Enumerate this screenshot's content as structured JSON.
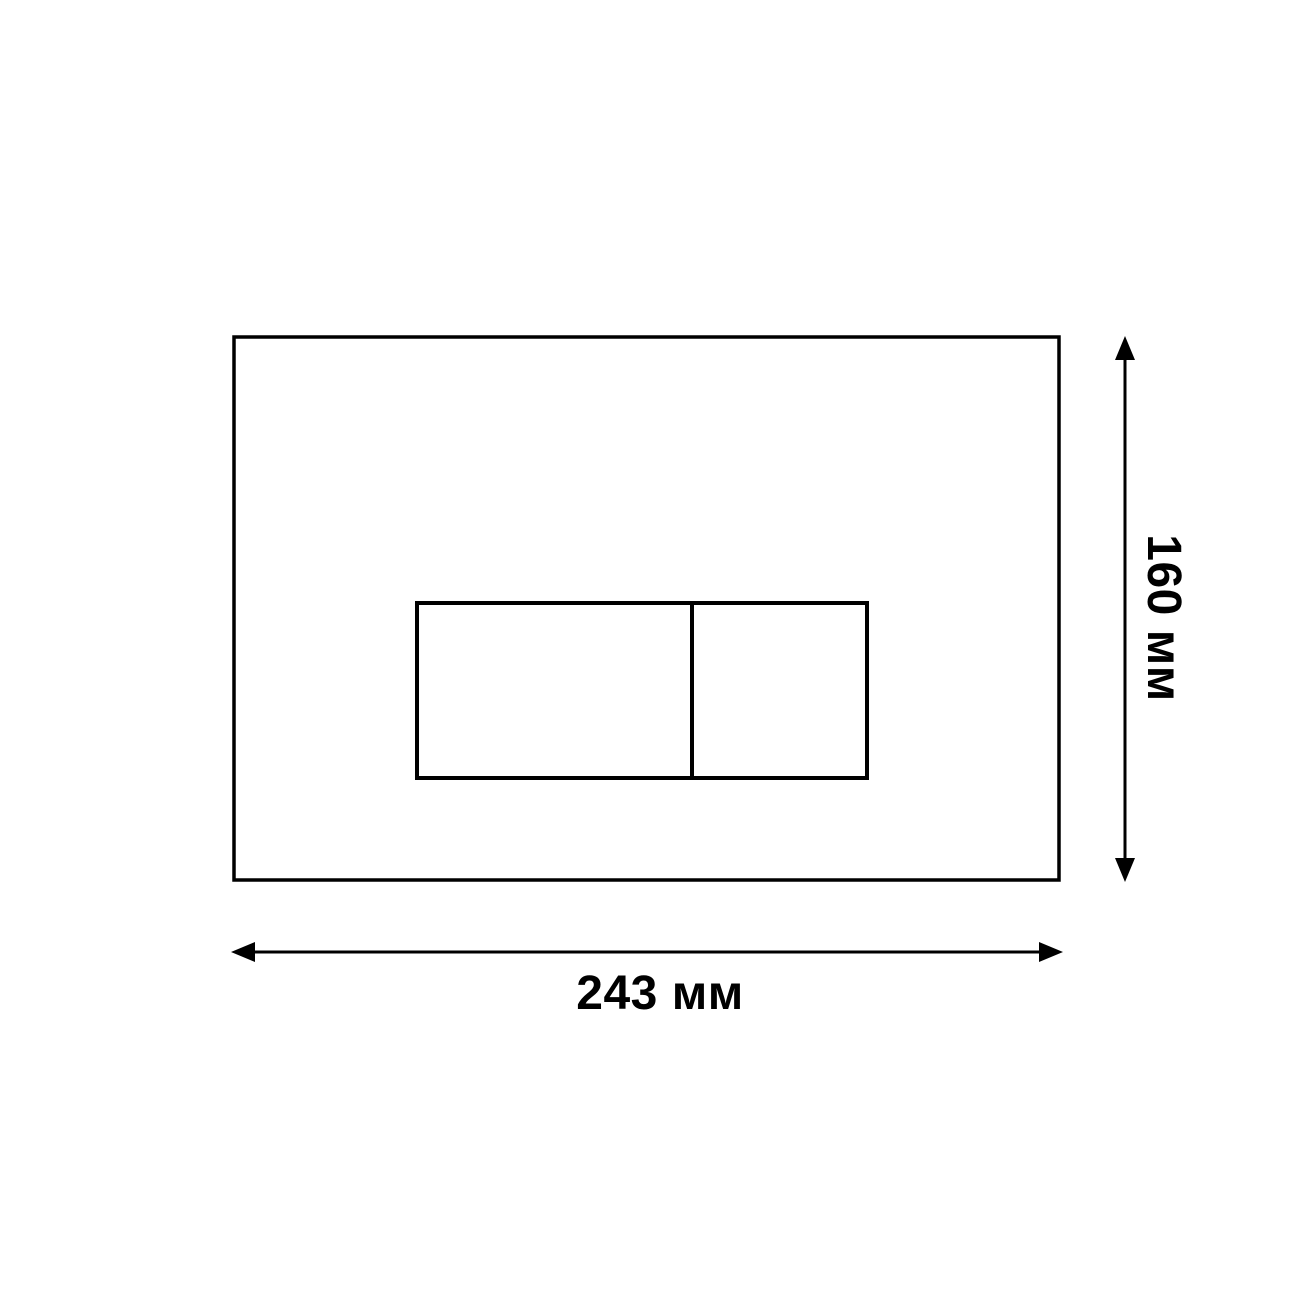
{
  "diagram": {
    "type": "technical-dimension-drawing",
    "description_visible_elements": "outer rectangular plate with inner two-button rectangle, width and height dimension arrows"
  },
  "labels": {
    "width": "243 мм",
    "height": "160 мм"
  },
  "dimensions": {
    "width_mm": 243,
    "height_mm": 160
  },
  "colors": {
    "background": "#ffffff",
    "ink": "#000000"
  }
}
